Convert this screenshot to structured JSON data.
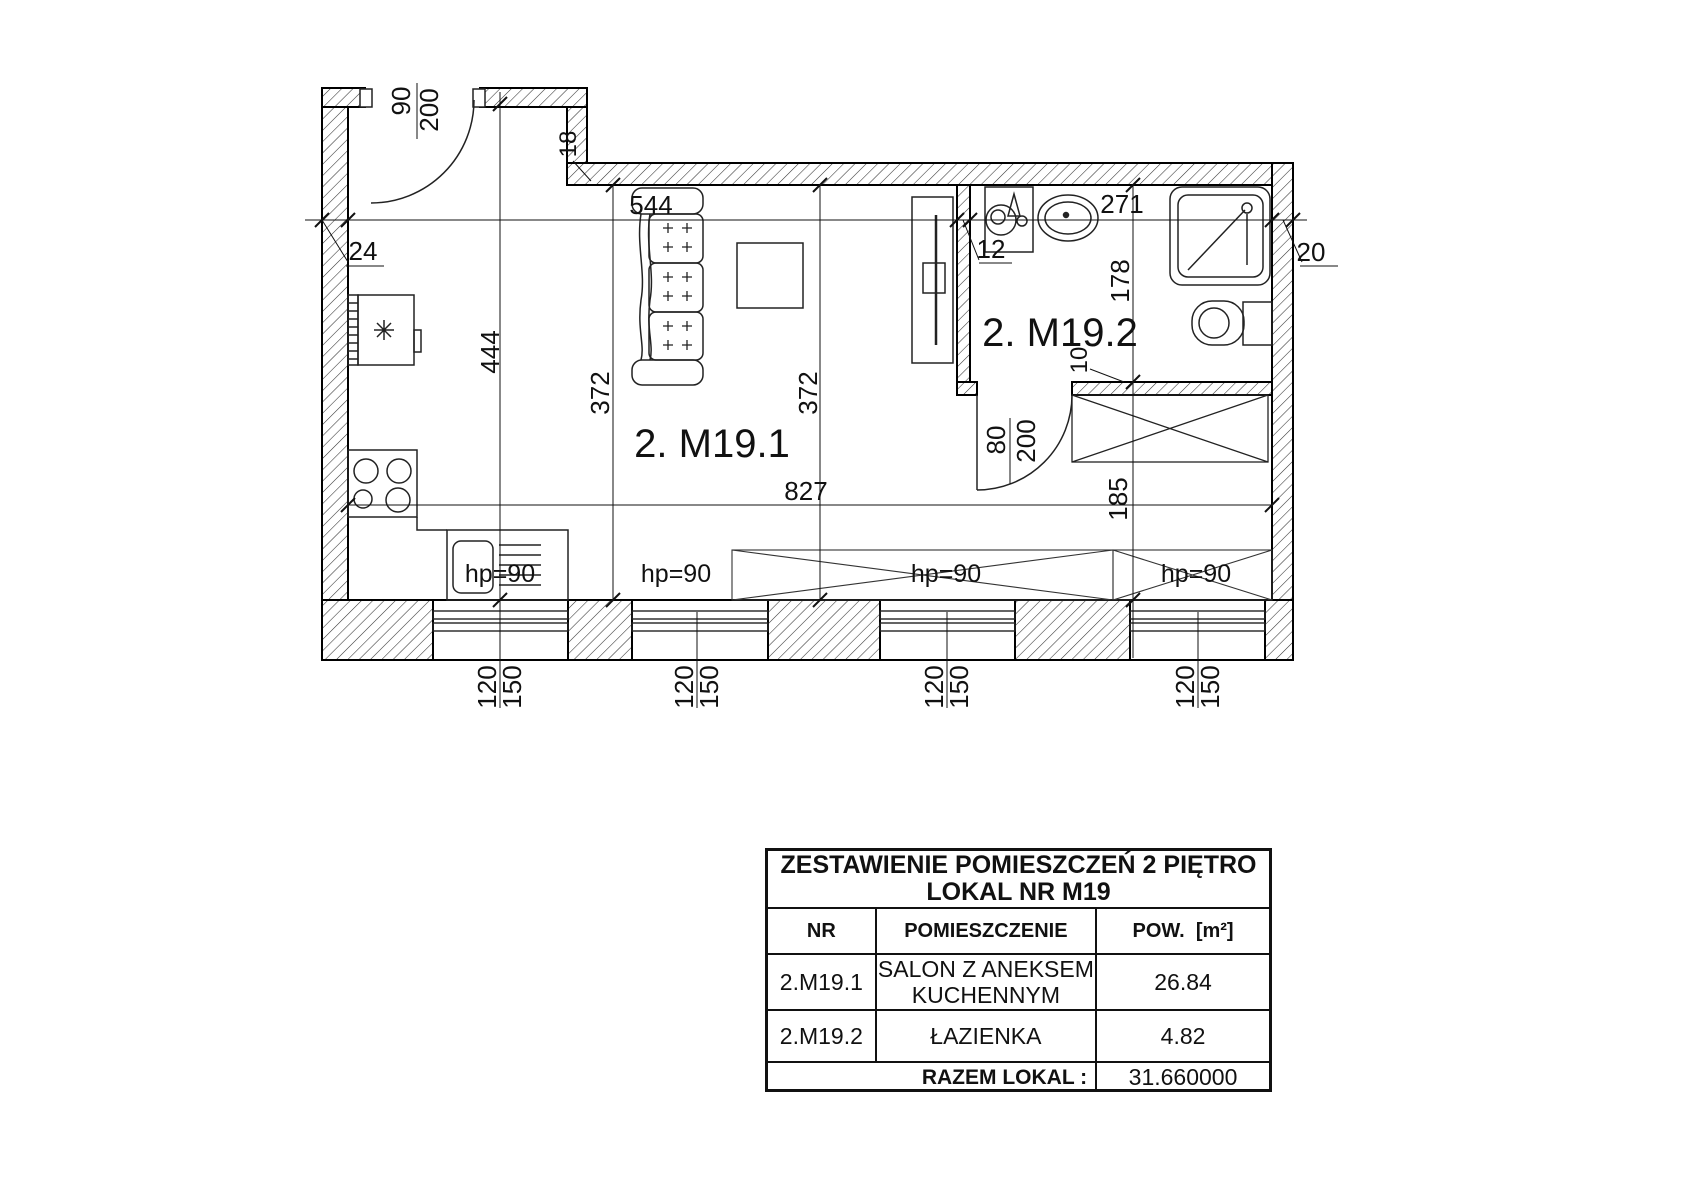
{
  "plan": {
    "room_living_label": "2. M19.1",
    "room_bath_label": "2. M19.2",
    "dims": {
      "top_left": "544",
      "top_bath": "271",
      "interior_width": "827",
      "kitchen_depth": "444",
      "living_depth_left": "372",
      "living_depth_right": "372",
      "bath_depth": "178",
      "wardrobe_depth": "185",
      "wall_left": "24",
      "wall_partition": "12",
      "wall_right": "20",
      "wall_step": "18",
      "wall_bath_bottom": "10",
      "entry_door": {
        "width": "90",
        "height": "200"
      },
      "bath_door": {
        "width": "80",
        "height": "200"
      }
    },
    "windows": {
      "hp": [
        "hp=90",
        "hp=90",
        "hp=90",
        "hp=90"
      ],
      "pairs": [
        {
          "w": "120",
          "h": "150"
        },
        {
          "w": "120",
          "h": "150"
        },
        {
          "w": "120",
          "h": "150"
        },
        {
          "w": "120",
          "h": "150"
        }
      ]
    }
  },
  "table": {
    "title_line1": "ZESTAWIENIE POMIESZCZEŃ 2 PIĘTRO",
    "title_line2": "LOKAL NR M19",
    "headers": {
      "nr": "NR",
      "room": "POMIESZCZENIE",
      "area": "POW.  [m²]"
    },
    "rows": [
      {
        "nr": "2.M19.1",
        "room": "SALON Z ANEKSEM KUCHENNYM",
        "area": "26.84"
      },
      {
        "nr": "2.M19.2",
        "room": "ŁAZIENKA",
        "area": "4.82"
      }
    ],
    "total_label": "RAZEM LOKAL :",
    "total_value": "31.660000"
  }
}
